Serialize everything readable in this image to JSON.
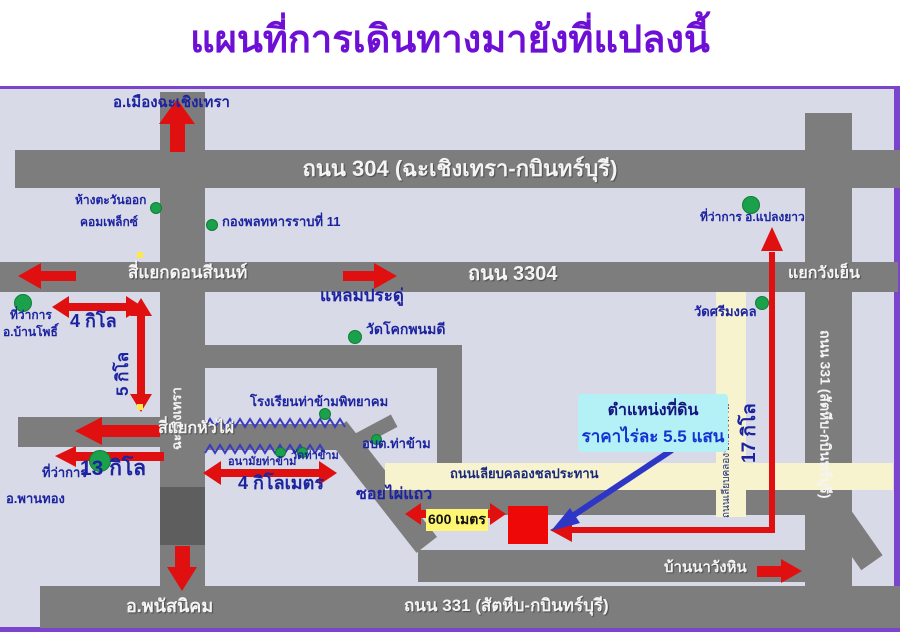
{
  "labels": {
    "title": "แผนที่การเดินทางมายังที่แปลงนี้",
    "mueang_chachoengsao": "อ.เมืองฉะเชิงเทรา",
    "road_304": "ถนน 304 (ฉะเชิงเทรา-กบินทร์บุรี)",
    "eastern_complex_line1": "ห้างตะวันออก",
    "eastern_complex_line2": "คอมเพล็กซ์",
    "infantry_div_11": "กองพลทหารราบที่ 11",
    "plaeng_yao_office": "ที่ว่าการ อ.แปลงยาว",
    "don_si_non_junction": "สี่แยกดอนสีนนท์",
    "road_3304": "ถนน 3304",
    "wang_yen_junction": "แยกวังเย็น",
    "laem_pradu": "แหลมประดู่",
    "district_office_word1": "ที่ว่าการ",
    "ban_pho": "อ.บ้านโพธิ์",
    "dist_4_kilo": "4 กิโล",
    "dist_5_kilo": "5 กิโล",
    "chachoengsao_road": "ฉะเชิงเทรา",
    "hua_phai_junction": "สี่แยกหัวไผ่",
    "dist_13_kilo": "13 กิโล",
    "district_office_word2": "ที่ว่าการ",
    "phan_thong": "อ.พานทอง",
    "tha_kham_school": "โรงเรียนท่าข้ามพิทยาคม",
    "tha_kham_health": "อนามัยท่าข้าม",
    "wat_tha_kham": "วัดท่าข้าม",
    "tha_kham_sao": "อบต.ท่าข้าม",
    "dist_4_km": "4 กิโลเมตร",
    "wat_khok_phanom_di": "วัดโคกพนมดี",
    "wat_si_mongkhon": "วัดศรีมงคล",
    "canal_road": "ถนนเลียบคลองชลประทาน",
    "canal_road_vertical": "ถนนเลียบคลองชลประทาน",
    "soi_phai_thaeo": "ซอยไผ่แถว",
    "dist_600_m": "600 เมตร",
    "plot_caption_line1": "ตำแหน่งที่ดิน",
    "plot_caption_line2": "ราคาไร่ละ 5.5 แสน",
    "dist_17_kilo": "17 กิโล",
    "road_331_right": "ถนน 331 (สัตหีบ-กบินทร์บุรี)",
    "ban_na_wang_hin": "บ้านนาวังหิน",
    "phanat_nikhom": "อ.พนัสนิคม",
    "road_331_bottom": "ถนน 331 (สัตหีบ-กบินทร์บุรี)"
  },
  "colors": {
    "title_purple": "#6e0fd6",
    "border_purple": "#7a45cc",
    "map_background": "#d8dae7",
    "road_gray": "#7d7d7d",
    "road_dark_gray": "#5e5e5e",
    "canal_cream": "#f8f3cf",
    "marker_green": "#1ba14b",
    "arrow_red": "#e01010",
    "pointer_blue": "#2e36c6",
    "label_blue": "#1c23a0",
    "price_blue": "#1334cf",
    "callout_cyan": "#b4f1f7",
    "distance_highlight_yellow": "#fff673",
    "plot_red": "#ee0808"
  }
}
